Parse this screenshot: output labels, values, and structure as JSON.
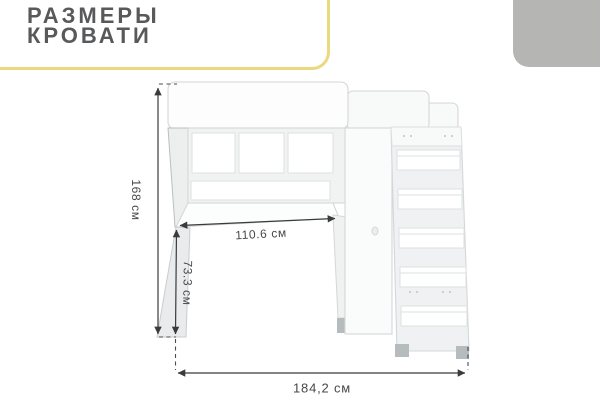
{
  "header": {
    "title_line1": "РАЗМЕРЫ",
    "title_line2": "КРОВАТИ"
  },
  "decor": {
    "accent_border_color": "#ecd87e",
    "corner_block_color": "#b5b5b4"
  },
  "diagram": {
    "subject": "loft-bed-with-desk-and-ladder-line-drawing",
    "units": "см",
    "dimensions": {
      "overall_height": "168 см",
      "desk_width": "110.6 см",
      "desk_height": "73.3 см",
      "overall_width": "184,2 см"
    },
    "line_color": "#3a3b3c",
    "sketch_color": "#d4d7d8"
  }
}
